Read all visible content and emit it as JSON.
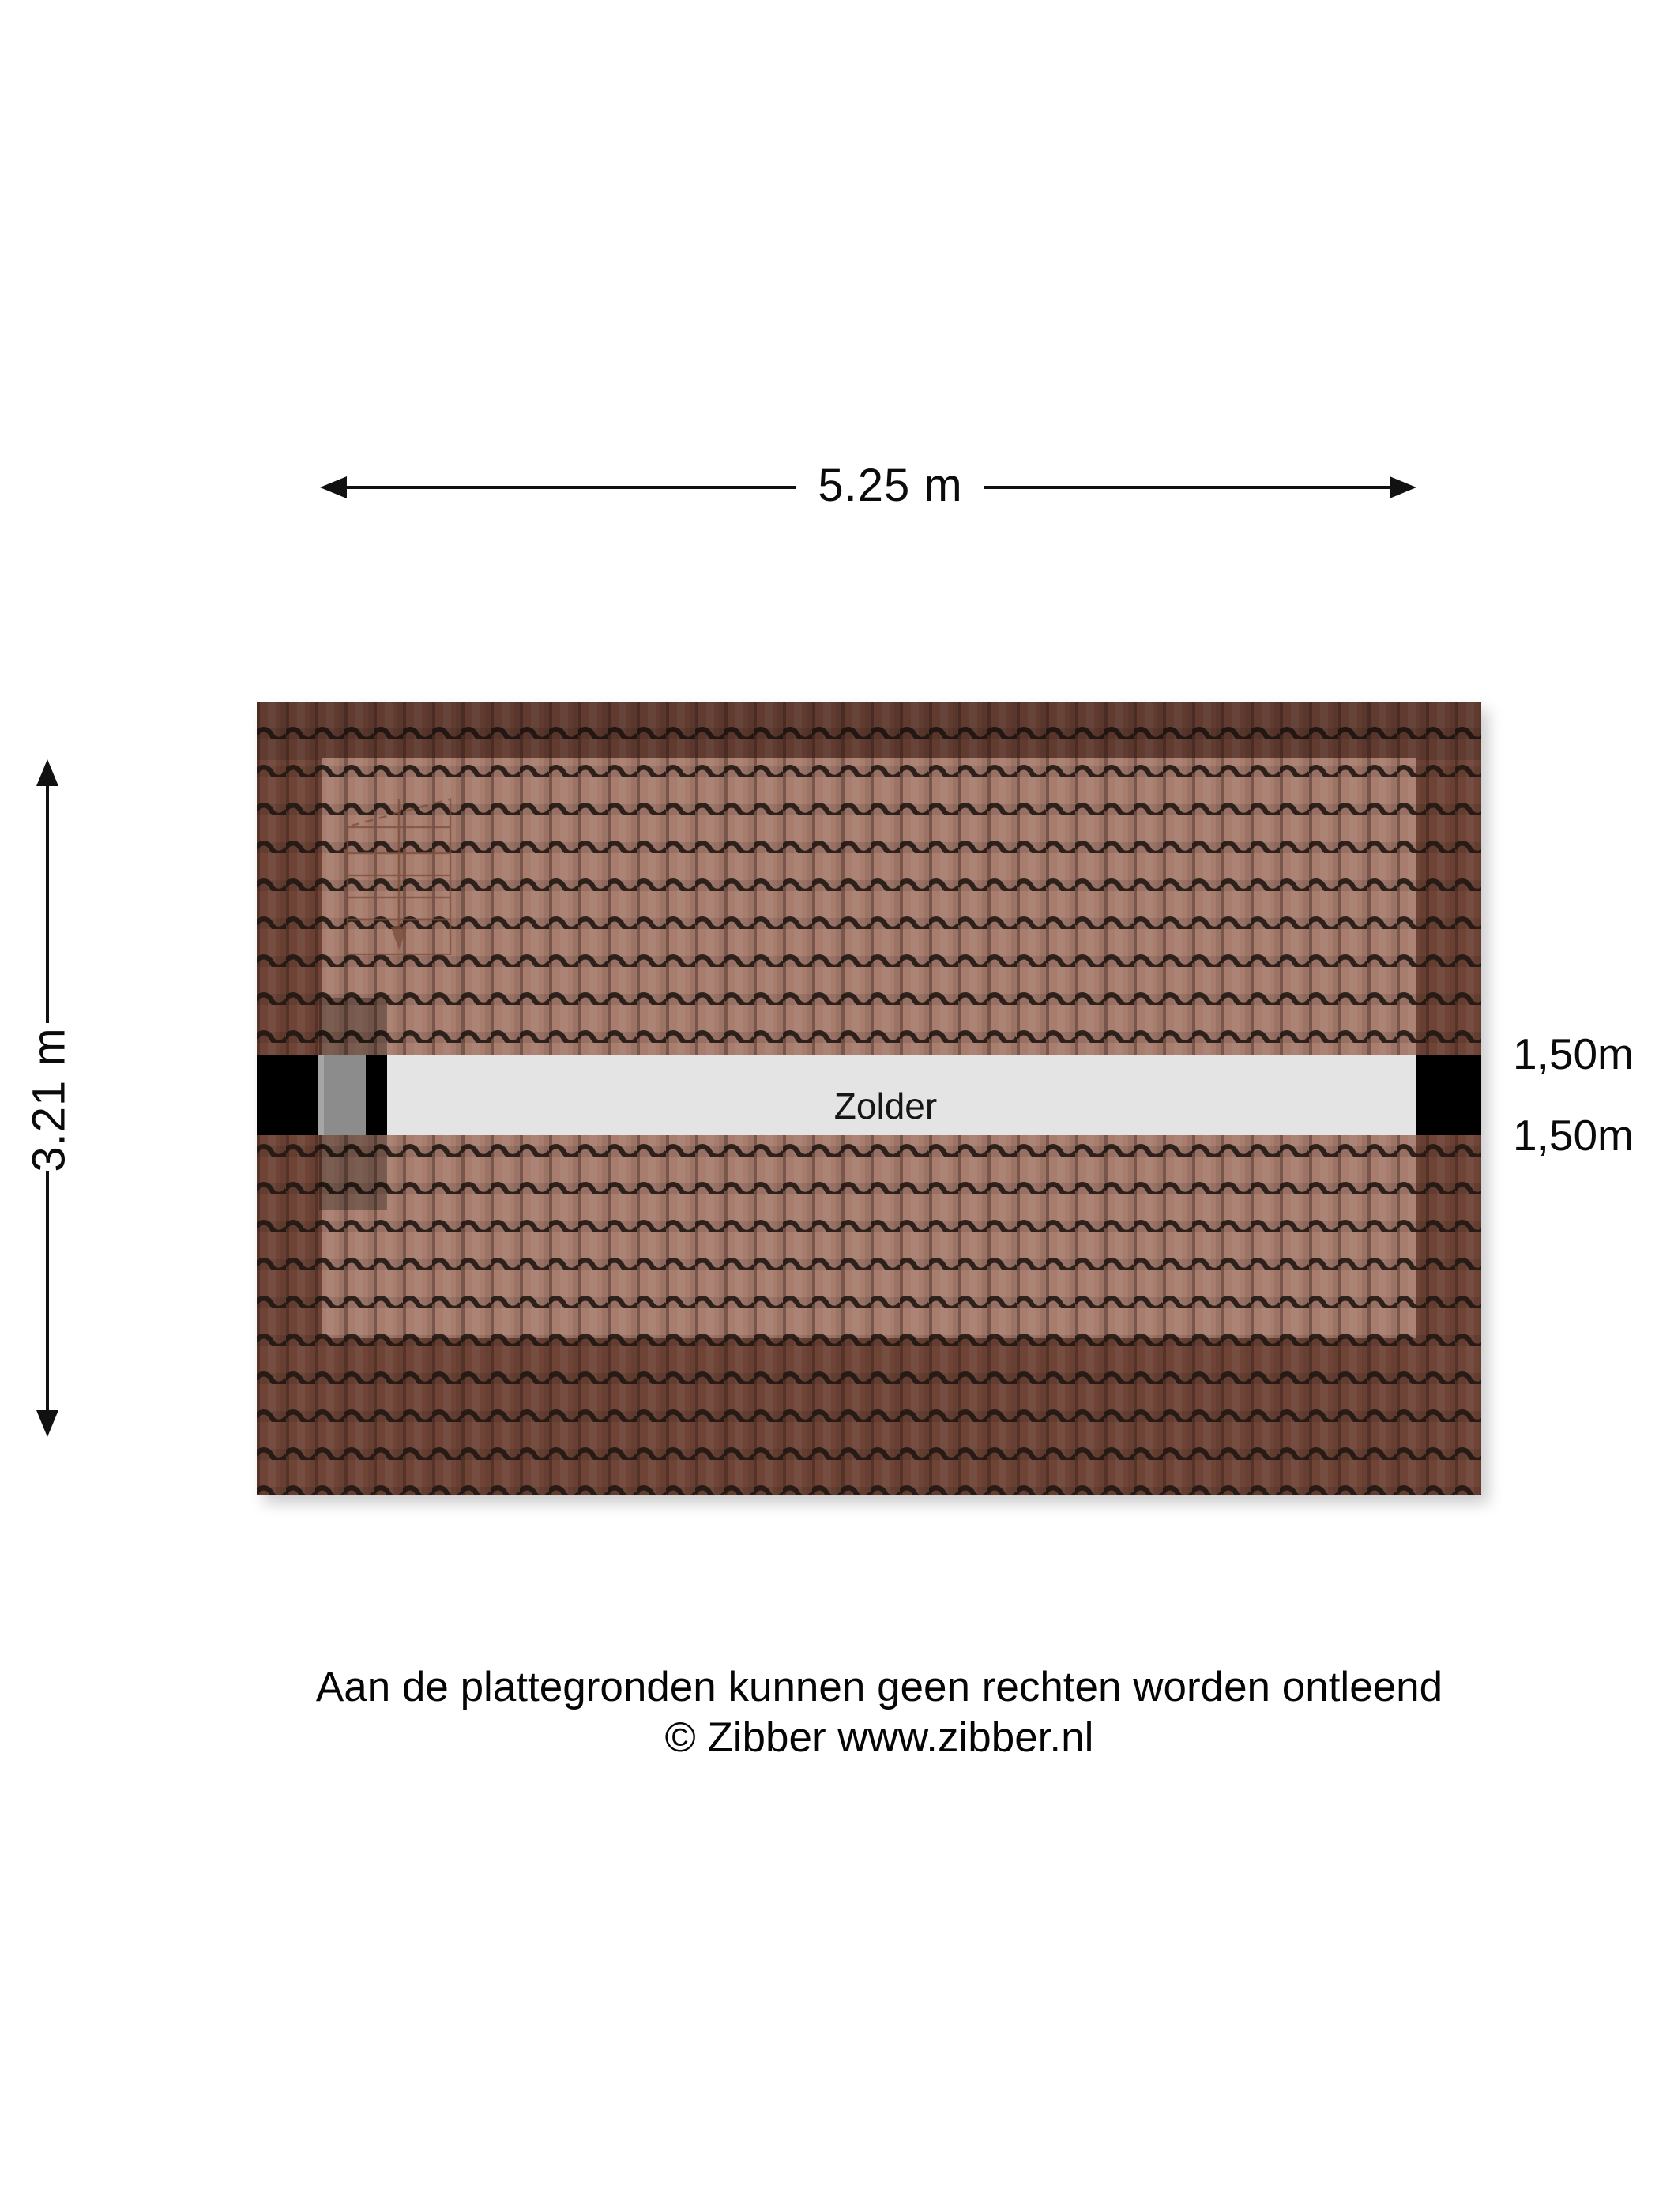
{
  "dimensions": {
    "top_width_label": "5.25 m",
    "left_height_label": "3.21 m",
    "right_labels": [
      "1,50m",
      "1,50m"
    ]
  },
  "floorplan": {
    "room_label": "Zolder",
    "colors": {
      "tile_border": "#6f4437",
      "tile_inner": "#a87d6e",
      "corridor_fill": "#e4e4e4",
      "end_block_black": "#000000",
      "window_gray": "#8c8c8c",
      "stair_line": "#7d4c39",
      "arrow_black": "#111111"
    }
  },
  "footer": {
    "disclaimer": "Aan de plattegronden kunnen geen rechten worden ontleend",
    "copyright": "© Zibber www.zibber.nl"
  }
}
